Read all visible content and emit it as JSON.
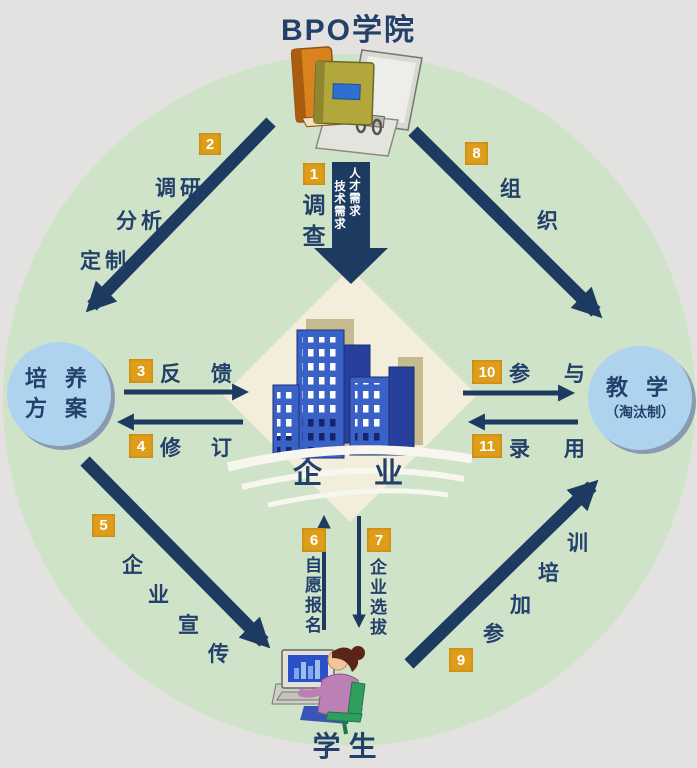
{
  "title": "BPO学院",
  "student_label": "学生",
  "enterprise_label": "企 业",
  "left_node": {
    "line1": "培 养",
    "line2": "方 案"
  },
  "right_node": {
    "line1": "教 学",
    "line2": "（淘汰制）"
  },
  "arrow1": {
    "badge": "1",
    "label": "调查",
    "need_right": "人才需求",
    "need_left": "技术需求"
  },
  "arrow2": {
    "badge": "2",
    "word1": "调研",
    "word2": "分析",
    "word3": "定制"
  },
  "arrow3": {
    "badge": "3",
    "label": "反 馈"
  },
  "arrow4": {
    "badge": "4",
    "label": "修 订"
  },
  "arrow5": {
    "badge": "5",
    "char1": "企",
    "char2": "业",
    "char3": "宣",
    "char4": "传"
  },
  "arrow6": {
    "badge": "6",
    "label": "自愿报名"
  },
  "arrow7": {
    "badge": "7",
    "label": "企业选拔"
  },
  "arrow8": {
    "badge": "8",
    "char1": "组",
    "char2": "织"
  },
  "arrow9": {
    "badge": "9",
    "char1": "参",
    "char2": "加",
    "char3": "培",
    "char4": "训"
  },
  "arrow10": {
    "badge": "10",
    "label": "参 与"
  },
  "arrow11": {
    "badge": "11",
    "label": "录 用"
  },
  "illustrations": {
    "top": "books-and-open-binder",
    "center": "blue-office-buildings-on-cream-diamond",
    "bottom": "student-at-computer"
  },
  "colors": {
    "background": "#e3e2e0",
    "circle_green": "#cfe3c8",
    "arrow_navy": "#1d3a60",
    "text_navy": "#23406b",
    "badge_orange": "#df9e1a",
    "node_blue": "#aed3ee",
    "building_blue": "#3a62c6",
    "diamond_cream": "#f2eedb"
  }
}
